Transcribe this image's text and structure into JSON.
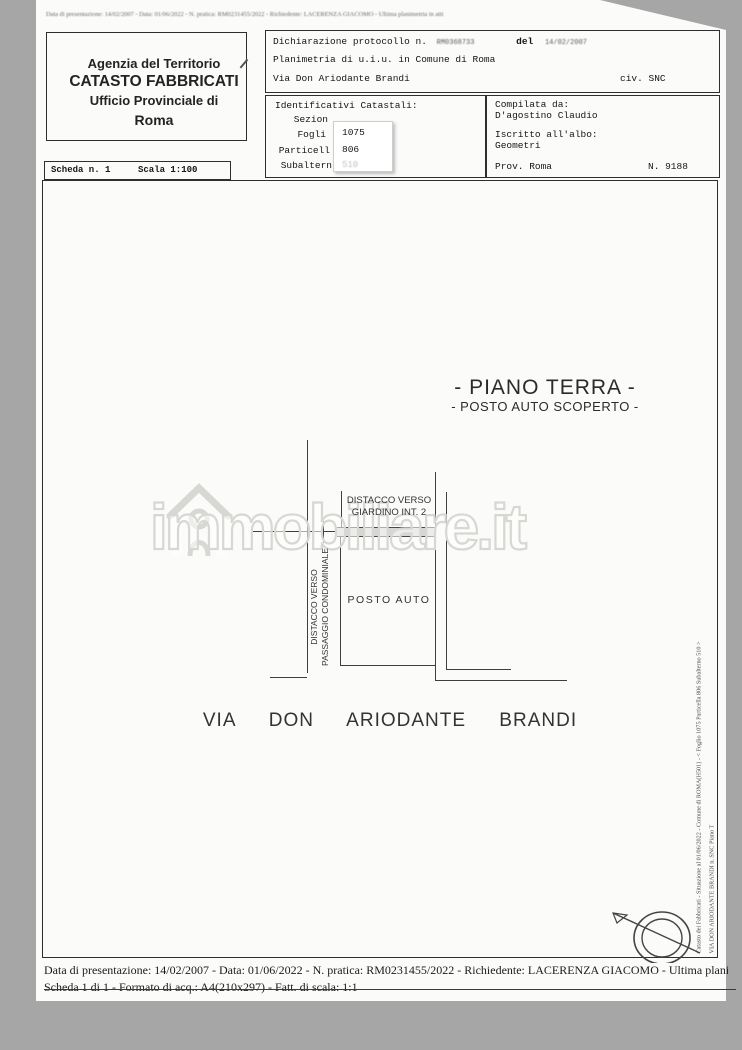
{
  "colors": {
    "scan_background": "#a6a6a6",
    "page_background": "#fbfbf9",
    "ink": "#1c1c1c",
    "plan_line": "#3f3f3f",
    "watermark": "#d7d7d4",
    "patch_white": "#ffffff"
  },
  "scan": {
    "top_line": "Data di presentazione: 14/02/2007 - Data: 01/06/2022 - N. pratica: RM0231455/2022 - Richiedente: LACERENZA GIACOMO - Ultima planimetria in atti"
  },
  "agency": {
    "line1": "Agenzia del Territorio",
    "line2": "CATASTO FABBRICATI",
    "line3": "Ufficio Provinciale di",
    "line4": "Roma"
  },
  "declaration": {
    "label": "Dichiarazione protocollo n.",
    "protocol_number": "RM0368733",
    "del_label": "del",
    "protocol_date": "14/02/2007",
    "line2": "Planimetria di u.i.u. in Comune di Roma",
    "address": "Via Don Ariodante Brandi",
    "civ": "civ. SNC"
  },
  "catastali": {
    "title": "Identificativi Catastali:",
    "rows": [
      {
        "label": "Sezion",
        "value": ""
      },
      {
        "label": "Fogli",
        "value": "1075"
      },
      {
        "label": "Particell",
        "value": "806"
      },
      {
        "label": "Subaltern",
        "value": "510"
      }
    ]
  },
  "compilata": {
    "label": "Compilata da:",
    "name": "D'agostino Claudio",
    "albo_label": "Iscritto all'albo:",
    "albo": "Geometri",
    "prov": "Prov. Roma",
    "number": "N. 9188"
  },
  "scheda": {
    "scheda_label": "Scheda n. 1",
    "scala_label": "Scala 1:100"
  },
  "plan": {
    "title": "- PIANO TERRA -",
    "subtitle": "- POSTO AUTO SCOPERTO -",
    "giardino_line1": "DISTACCO VERSO",
    "giardino_line2": "GIARDINO INT. 2",
    "posto_auto": "POSTO AUTO",
    "passaggio_line1": "DISTACCO VERSO",
    "passaggio_line2": "PASSAGGIO CONDOMINIALE",
    "street": "VIA DON ARIODANTE BRANDI"
  },
  "watermark": {
    "text": "immobiliare.it",
    "icon": "house-icon"
  },
  "sidebar": {
    "line1": "Catasto dei Fabbricati - Situazione al 01/06/2022 - Comune di ROMA(H501) - < Foglio 1075 Particella 806 Subalterno 510 >",
    "line2": "VIA DON ARIODANTE BRANDI n. SNC Piano T"
  },
  "footer": {
    "line1": "Data di presentazione: 14/02/2007 - Data: 01/06/2022 - N. pratica: RM0231455/2022 - Richiedente: LACERENZA GIACOMO - Ultima plani",
    "line2": "Scheda 1 di 1 - Formato di acq.: A4(210x297) - Fatt. di scala: 1:1"
  },
  "compass": {
    "icon": "north-arrow-icon"
  }
}
